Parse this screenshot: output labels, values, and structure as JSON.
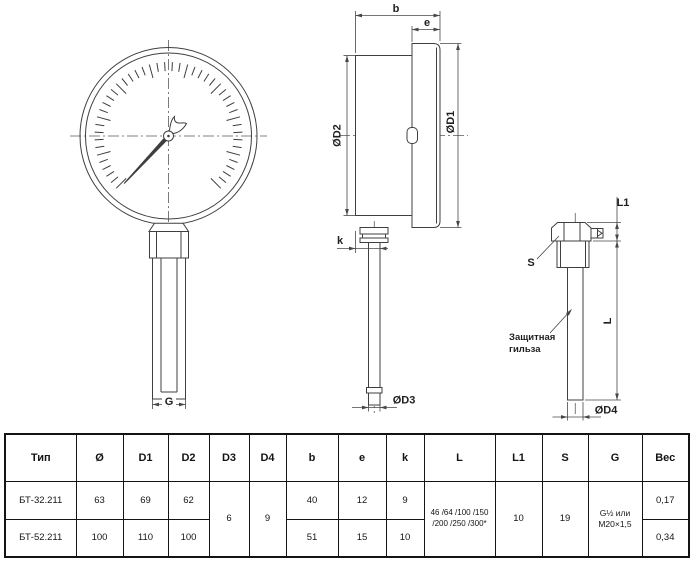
{
  "drawing": {
    "stroke_color": "#3f3f3f",
    "labels": {
      "b": "b",
      "e": "e",
      "k": "k",
      "d1": "ØD1",
      "d2": "ØD2",
      "d3": "ØD3",
      "d4": "ØD4",
      "L": "L",
      "L1": "L1",
      "S": "S",
      "G": "G",
      "sleeve1": "Защитная",
      "sleeve2": "гильза"
    },
    "gauge": {
      "tick_count": 46,
      "start_angle": 135,
      "sweep": 270,
      "tick_outer_r": 74,
      "tick_len_minor": 9,
      "tick_len_major": 14,
      "major_every": 5,
      "needle_angle": 133,
      "needle_len": 65
    }
  },
  "table": {
    "headers": [
      "Тип",
      "Ø",
      "D1",
      "D2",
      "D3",
      "D4",
      "b",
      "e",
      "k",
      "L",
      "L1",
      "S",
      "G",
      "Вес"
    ],
    "merged": {
      "d3": "6",
      "d4": "9",
      "l_lines": [
        "46 /64 /100 /150",
        "/200 /250 /300*"
      ],
      "l1": "10",
      "s": "19",
      "g_lines": [
        "G½ или",
        "M20×1,5"
      ]
    },
    "rows": [
      {
        "type": "БТ-32.211",
        "dia": "63",
        "d1": "69",
        "d2": "62",
        "b": "40",
        "e": "12",
        "k": "9",
        "ves": "0,17"
      },
      {
        "type": "БТ-52.211",
        "dia": "100",
        "d1": "110",
        "d2": "100",
        "b": "51",
        "e": "15",
        "k": "10",
        "ves": "0,34"
      }
    ]
  }
}
